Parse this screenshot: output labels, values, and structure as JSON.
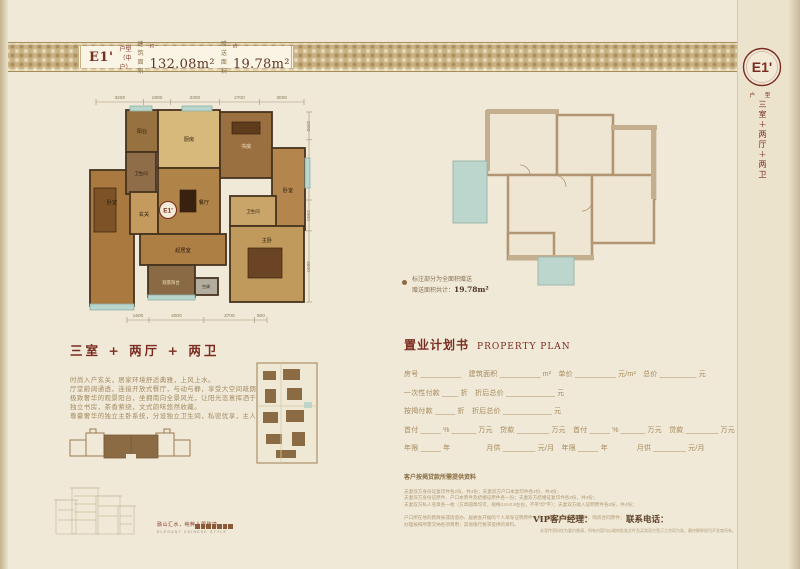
{
  "header": {
    "code": "E1'",
    "type_label": "户型（中户）",
    "build_area_label": "建筑面积",
    "build_area_value": "132.08m²",
    "gift_area_label": "赠送面积",
    "gift_area_value": "19.78m²",
    "sup": "约"
  },
  "side": {
    "badge": "E1'",
    "badge_caption": "户 型",
    "layout_vertical": "三室＋两厅＋两卫"
  },
  "plan": {
    "dims_top": [
      "3200",
      "1800",
      "3300",
      "2700",
      "3000"
    ],
    "dims_bottom": [
      "1600",
      "4000",
      "3700",
      "900"
    ],
    "dims_right": [
      "1800",
      "3900",
      "2000",
      "4600"
    ],
    "rooms": {
      "bedroom_left": "卧室",
      "balcony_top": "阳台",
      "bath_left": "卫生间",
      "kitchen": "厨房",
      "study": "书房",
      "bedroom_right": "卧室",
      "entry": "玄关",
      "dining": "餐厅",
      "living": "起居室",
      "bath_right": "卫生间",
      "master": "主卧",
      "balcony_south": "观景阳台",
      "ac": "空调",
      "badge": "E1'"
    }
  },
  "gift_note": {
    "line1": "标注部分为全面积赠送",
    "line2_label": "赠送面积共计：",
    "value": "19.78m²"
  },
  "intro": {
    "heading": "三室 + 两厅 + 两卫",
    "lines": [
      "时尚入户玄关，居家环境舒适典雅，上风上水。",
      "厅堂蔚阔通透，连接开放式餐厅，与动与静，享受大空间疏朗、惬意。",
      "极致奢华的观景阳台，坐拥南向全景风光，让阳光恣意挥洒于生活每处。",
      "独立书房，茶香萦绕，文式韵味悠然收藏。",
      "尊豪奢华的独立主卧系统，分设独立卫生间，私密优享，主人至尊人生。"
    ]
  },
  "property_plan": {
    "title": "置业计划书",
    "title_en": "PROPERTY PLAN",
    "rows": [
      "房号 __________　建筑面积 __________ m²　单价 __________ 元/m²　总价 _________ 元",
      "一次性付款 ____ 折　折后总价 ____________ 元",
      "按揭付款 _____ 折　折后总价 ____________ 元",
      "首付 _____ % ______ 万元　贷款 ________ 万元　首付 _____ % ______ 万元　贷款 ________ 万元",
      "年限 _____ 年　　　　　月供 ________ 元/月　年限 _____ 年　　　　月供 ________ 元/月"
    ]
  },
  "mortgage_docs": {
    "heading": "客户按揭贷款所需提供资料",
    "lines": [
      "夫妻双方身份证复印件各2份，共4份；夫妻双方户口本复印件各2份，共4份；",
      "夫妻双方身份证原件、户口本原件及结婚证原件各一份；夫妻双方结婚证复印件各2份，共4份；",
      "夫妻双方私人名章各一枚（方章圆章均可，规格0.8×0.8左右，不带“印”字）；夫妻双方收入证明原件各2份，共4份；",
      "户口所在地的民政局或街道办、居委会开据的个人单身证明原件一份；购房首付款收据原件；购房合同原件；",
      "办理按揭所需交纳各项费用；其他银行要求提供的资料。"
    ]
  },
  "contact": {
    "vip_label": "VIP客户经理：",
    "phone_label": "联系电话：",
    "disclaimer": "本宣传资料仅为要约邀请，所有内容均以政府批准文件及买卖双方签订之合同为准，最终解释权归开发商所有。"
  },
  "brand": {
    "slogan": "融山汇水，纯粹人居臻境",
    "slogan_en": "ELEGANT CHINESE STYLE"
  }
}
